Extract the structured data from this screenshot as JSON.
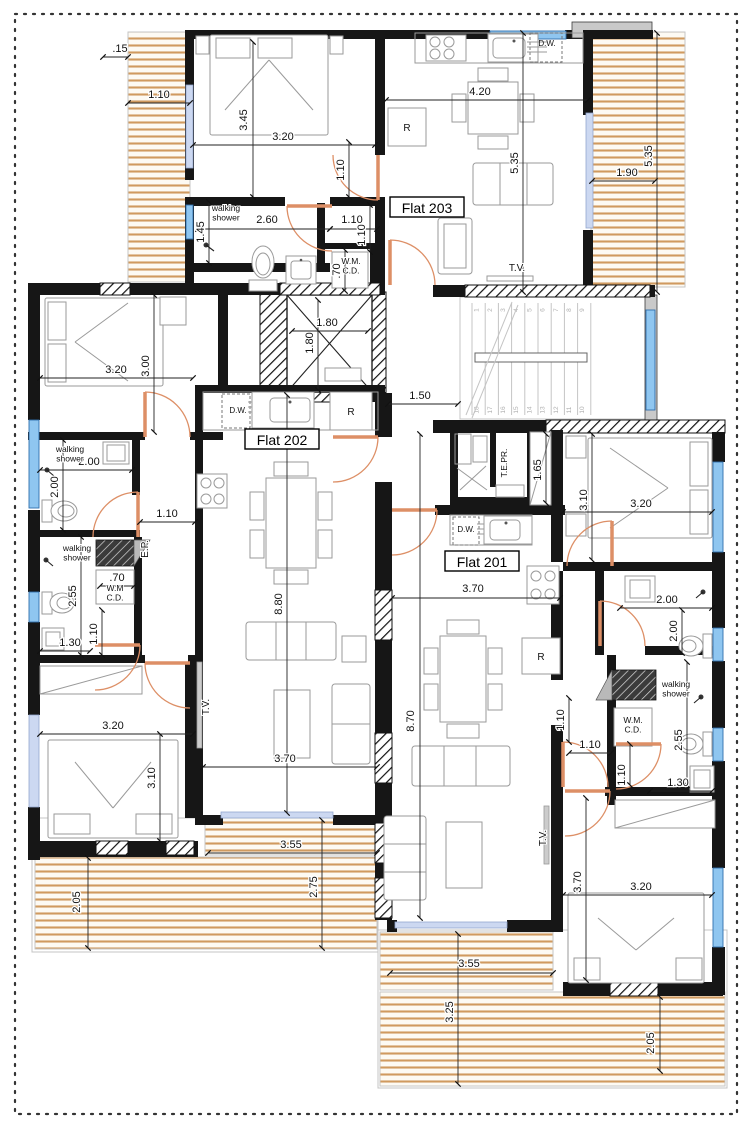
{
  "drawing": {
    "type": "architectural floor plan",
    "flats": [
      {
        "label": "Flat 201"
      },
      {
        "label": "Flat 202"
      },
      {
        "label": "Flat 203"
      }
    ]
  },
  "colors": {
    "wall": "#161616",
    "deck_stripe": "#d09a5f",
    "window": "#8fc6f0",
    "door_arc": "#dd8f66",
    "dim_text": "#111111"
  },
  "stairs": {
    "upper_steps": [
      "1",
      "2",
      "3",
      "4",
      "5",
      "6",
      "7",
      "8",
      "9"
    ],
    "lower_steps": [
      "18",
      "17",
      "16",
      "15",
      "14",
      "13",
      "12",
      "11",
      "10"
    ]
  },
  "annotations": [
    {
      "t": "Flat 203",
      "x": 427,
      "y": 209,
      "c": "flat",
      "n": "label-flat-203"
    },
    {
      "t": "Flat 202",
      "x": 282,
      "y": 441,
      "c": "flat",
      "n": "label-flat-202"
    },
    {
      "t": "Flat 201",
      "x": 482,
      "y": 563,
      "c": "flat",
      "n": "label-flat-201"
    },
    {
      "t": ".15",
      "x": 120,
      "y": 52
    },
    {
      "t": "1.10",
      "x": 159,
      "y": 98
    },
    {
      "t": "3.45",
      "x": 247,
      "y": 120,
      "r": -90
    },
    {
      "t": "3.20",
      "x": 283,
      "y": 140
    },
    {
      "t": "1.10",
      "x": 344,
      "y": 170,
      "r": -90
    },
    {
      "t": "2.60",
      "x": 267,
      "y": 223
    },
    {
      "t": "1.45",
      "x": 204,
      "y": 232,
      "r": -90
    },
    {
      "t": "1.10",
      "x": 352,
      "y": 223
    },
    {
      "t": "1.10",
      "x": 365,
      "y": 235,
      "r": -90
    },
    {
      "t": ".70",
      "x": 340,
      "y": 271,
      "r": -90
    },
    {
      "t": "4.20",
      "x": 480,
      "y": 95
    },
    {
      "t": "5.35",
      "x": 518,
      "y": 163,
      "r": -90
    },
    {
      "t": "1.90",
      "x": 627,
      "y": 176
    },
    {
      "t": "5.35",
      "x": 652,
      "y": 156,
      "r": -90
    },
    {
      "t": "1.80",
      "x": 327,
      "y": 326
    },
    {
      "t": "1.80",
      "x": 313,
      "y": 343,
      "r": -90
    },
    {
      "t": "1.50",
      "x": 420,
      "y": 399
    },
    {
      "t": "3.20",
      "x": 116,
      "y": 373
    },
    {
      "t": "3.00",
      "x": 149,
      "y": 366,
      "r": -90
    },
    {
      "t": "2.00",
      "x": 89,
      "y": 465
    },
    {
      "t": "2.00",
      "x": 58,
      "y": 487,
      "r": -90
    },
    {
      "t": "1.10",
      "x": 167,
      "y": 517
    },
    {
      "t": ".70",
      "x": 117,
      "y": 581
    },
    {
      "t": "2.55",
      "x": 76,
      "y": 596,
      "r": -90
    },
    {
      "t": "1.10",
      "x": 97,
      "y": 634,
      "r": -90
    },
    {
      "t": "1.30",
      "x": 70,
      "y": 646
    },
    {
      "t": "3.20",
      "x": 113,
      "y": 729
    },
    {
      "t": "3.10",
      "x": 155,
      "y": 778,
      "r": -90
    },
    {
      "t": "3.70",
      "x": 285,
      "y": 762
    },
    {
      "t": "8.80",
      "x": 282,
      "y": 604,
      "r": -90
    },
    {
      "t": "3.55",
      "x": 291,
      "y": 848
    },
    {
      "t": "2.05",
      "x": 80,
      "y": 902,
      "r": -90
    },
    {
      "t": "2.75",
      "x": 317,
      "y": 887,
      "r": -90
    },
    {
      "t": "1.65",
      "x": 541,
      "y": 470,
      "r": -90
    },
    {
      "t": "3.10",
      "x": 587,
      "y": 500,
      "r": -90
    },
    {
      "t": "3.20",
      "x": 641,
      "y": 507
    },
    {
      "t": "3.70",
      "x": 473,
      "y": 592
    },
    {
      "t": "8.70",
      "x": 414,
      "y": 721,
      "r": -90
    },
    {
      "t": "1.10",
      "x": 564,
      "y": 720,
      "r": -90
    },
    {
      "t": "1.10",
      "x": 590,
      "y": 748
    },
    {
      "t": "2.00",
      "x": 667,
      "y": 603
    },
    {
      "t": "2.00",
      "x": 677,
      "y": 631,
      "r": -90
    },
    {
      "t": "2.55",
      "x": 682,
      "y": 740,
      "r": -90
    },
    {
      "t": "1.10",
      "x": 625,
      "y": 775,
      "r": -90
    },
    {
      "t": "1.30",
      "x": 678,
      "y": 786
    },
    {
      "t": "3.70",
      "x": 581,
      "y": 882,
      "r": -90
    },
    {
      "t": "3.20",
      "x": 641,
      "y": 890
    },
    {
      "t": "3.55",
      "x": 469,
      "y": 967
    },
    {
      "t": "3.25",
      "x": 453,
      "y": 1012,
      "r": -90
    },
    {
      "t": "2.05",
      "x": 654,
      "y": 1043,
      "r": -90
    },
    {
      "t": "walking\nshower",
      "x": 226,
      "y": 211,
      "c": "room",
      "n": "label-walking-shower-203"
    },
    {
      "t": "walking\nshower",
      "x": 70,
      "y": 452,
      "c": "room",
      "n": "label-walking-shower-202a"
    },
    {
      "t": "walking\nshower",
      "x": 77,
      "y": 551,
      "c": "room",
      "n": "label-walking-shower-202b"
    },
    {
      "t": "walking\nshower",
      "x": 676,
      "y": 687,
      "c": "room",
      "n": "label-walking-shower-201"
    },
    {
      "t": "W.M.\nC.D.",
      "x": 351,
      "y": 264,
      "c": "room",
      "n": "label-wm-cd-203"
    },
    {
      "t": "W.M\nC.D.",
      "x": 115,
      "y": 591,
      "c": "room",
      "n": "label-wm-cd-202"
    },
    {
      "t": "W.M.\nC.D.",
      "x": 633,
      "y": 723,
      "c": "room",
      "n": "label-wm-cd-201"
    },
    {
      "t": "E.P.",
      "x": 148,
      "y": 549,
      "r": -90,
      "c": "tv",
      "n": "label-ep"
    },
    {
      "t": "T.E.PR.",
      "x": 507,
      "y": 463,
      "r": -90,
      "c": "room",
      "n": "label-tepr"
    },
    {
      "t": "T.V.",
      "x": 517,
      "y": 271,
      "c": "tv",
      "n": "label-tv-203"
    },
    {
      "t": "T.V.",
      "x": 209,
      "y": 707,
      "r": -90,
      "c": "tv",
      "n": "label-tv-202"
    },
    {
      "t": "T.V.",
      "x": 546,
      "y": 838,
      "r": -90,
      "c": "tv",
      "n": "label-tv-201"
    },
    {
      "t": "D.W.",
      "x": 547,
      "y": 46,
      "c": "fix",
      "n": "label-dw-203"
    },
    {
      "t": "D.W.",
      "x": 238,
      "y": 413,
      "c": "fix",
      "n": "label-dw-202"
    },
    {
      "t": "D.W.",
      "x": 466,
      "y": 532,
      "c": "fix",
      "n": "label-dw-201"
    },
    {
      "t": "R",
      "x": 407,
      "y": 131,
      "c": "fixr",
      "n": "label-fridge-203"
    },
    {
      "t": "R",
      "x": 351,
      "y": 415,
      "c": "fixr",
      "n": "label-fridge-202"
    },
    {
      "t": "R",
      "x": 541,
      "y": 660,
      "c": "fixr",
      "n": "label-fridge-201"
    }
  ]
}
